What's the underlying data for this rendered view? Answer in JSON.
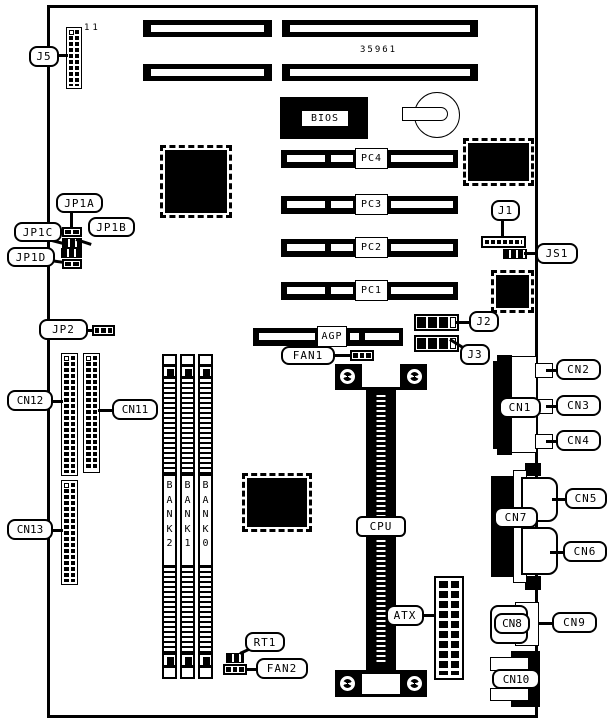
{
  "diagram": {
    "part_number": "35961",
    "j5_pin_count_label": "11"
  },
  "labels": {
    "j5": "J5",
    "jp1a": "JP1A",
    "jp1b": "JP1B",
    "jp1c": "JP1C",
    "jp1d": "JP1D",
    "jp2": "JP2",
    "j1": "J1",
    "js1": "JS1",
    "j2": "J2",
    "j3": "J3",
    "cn1": "CN1",
    "cn2": "CN2",
    "cn3": "CN3",
    "cn4": "CN4",
    "cn5": "CN5",
    "cn6": "CN6",
    "cn7": "CN7",
    "cn8": "CN8",
    "cn9": "CN9",
    "cn10": "CN10",
    "cn11": "CN11",
    "cn12": "CN12",
    "cn13": "CN13",
    "fan1": "FAN1",
    "fan2": "FAN2",
    "rt1": "RT1",
    "bios": "BIOS",
    "agp": "AGP",
    "cpu": "CPU",
    "atx": "ATX",
    "pc1": "PC1",
    "pc2": "PC2",
    "pc3": "PC3",
    "pc4": "PC4",
    "bank0": "BANK0",
    "bank1": "BANK1",
    "bank2": "BANK2"
  },
  "colors": {
    "ink": "#000000",
    "paper": "#ffffff"
  }
}
